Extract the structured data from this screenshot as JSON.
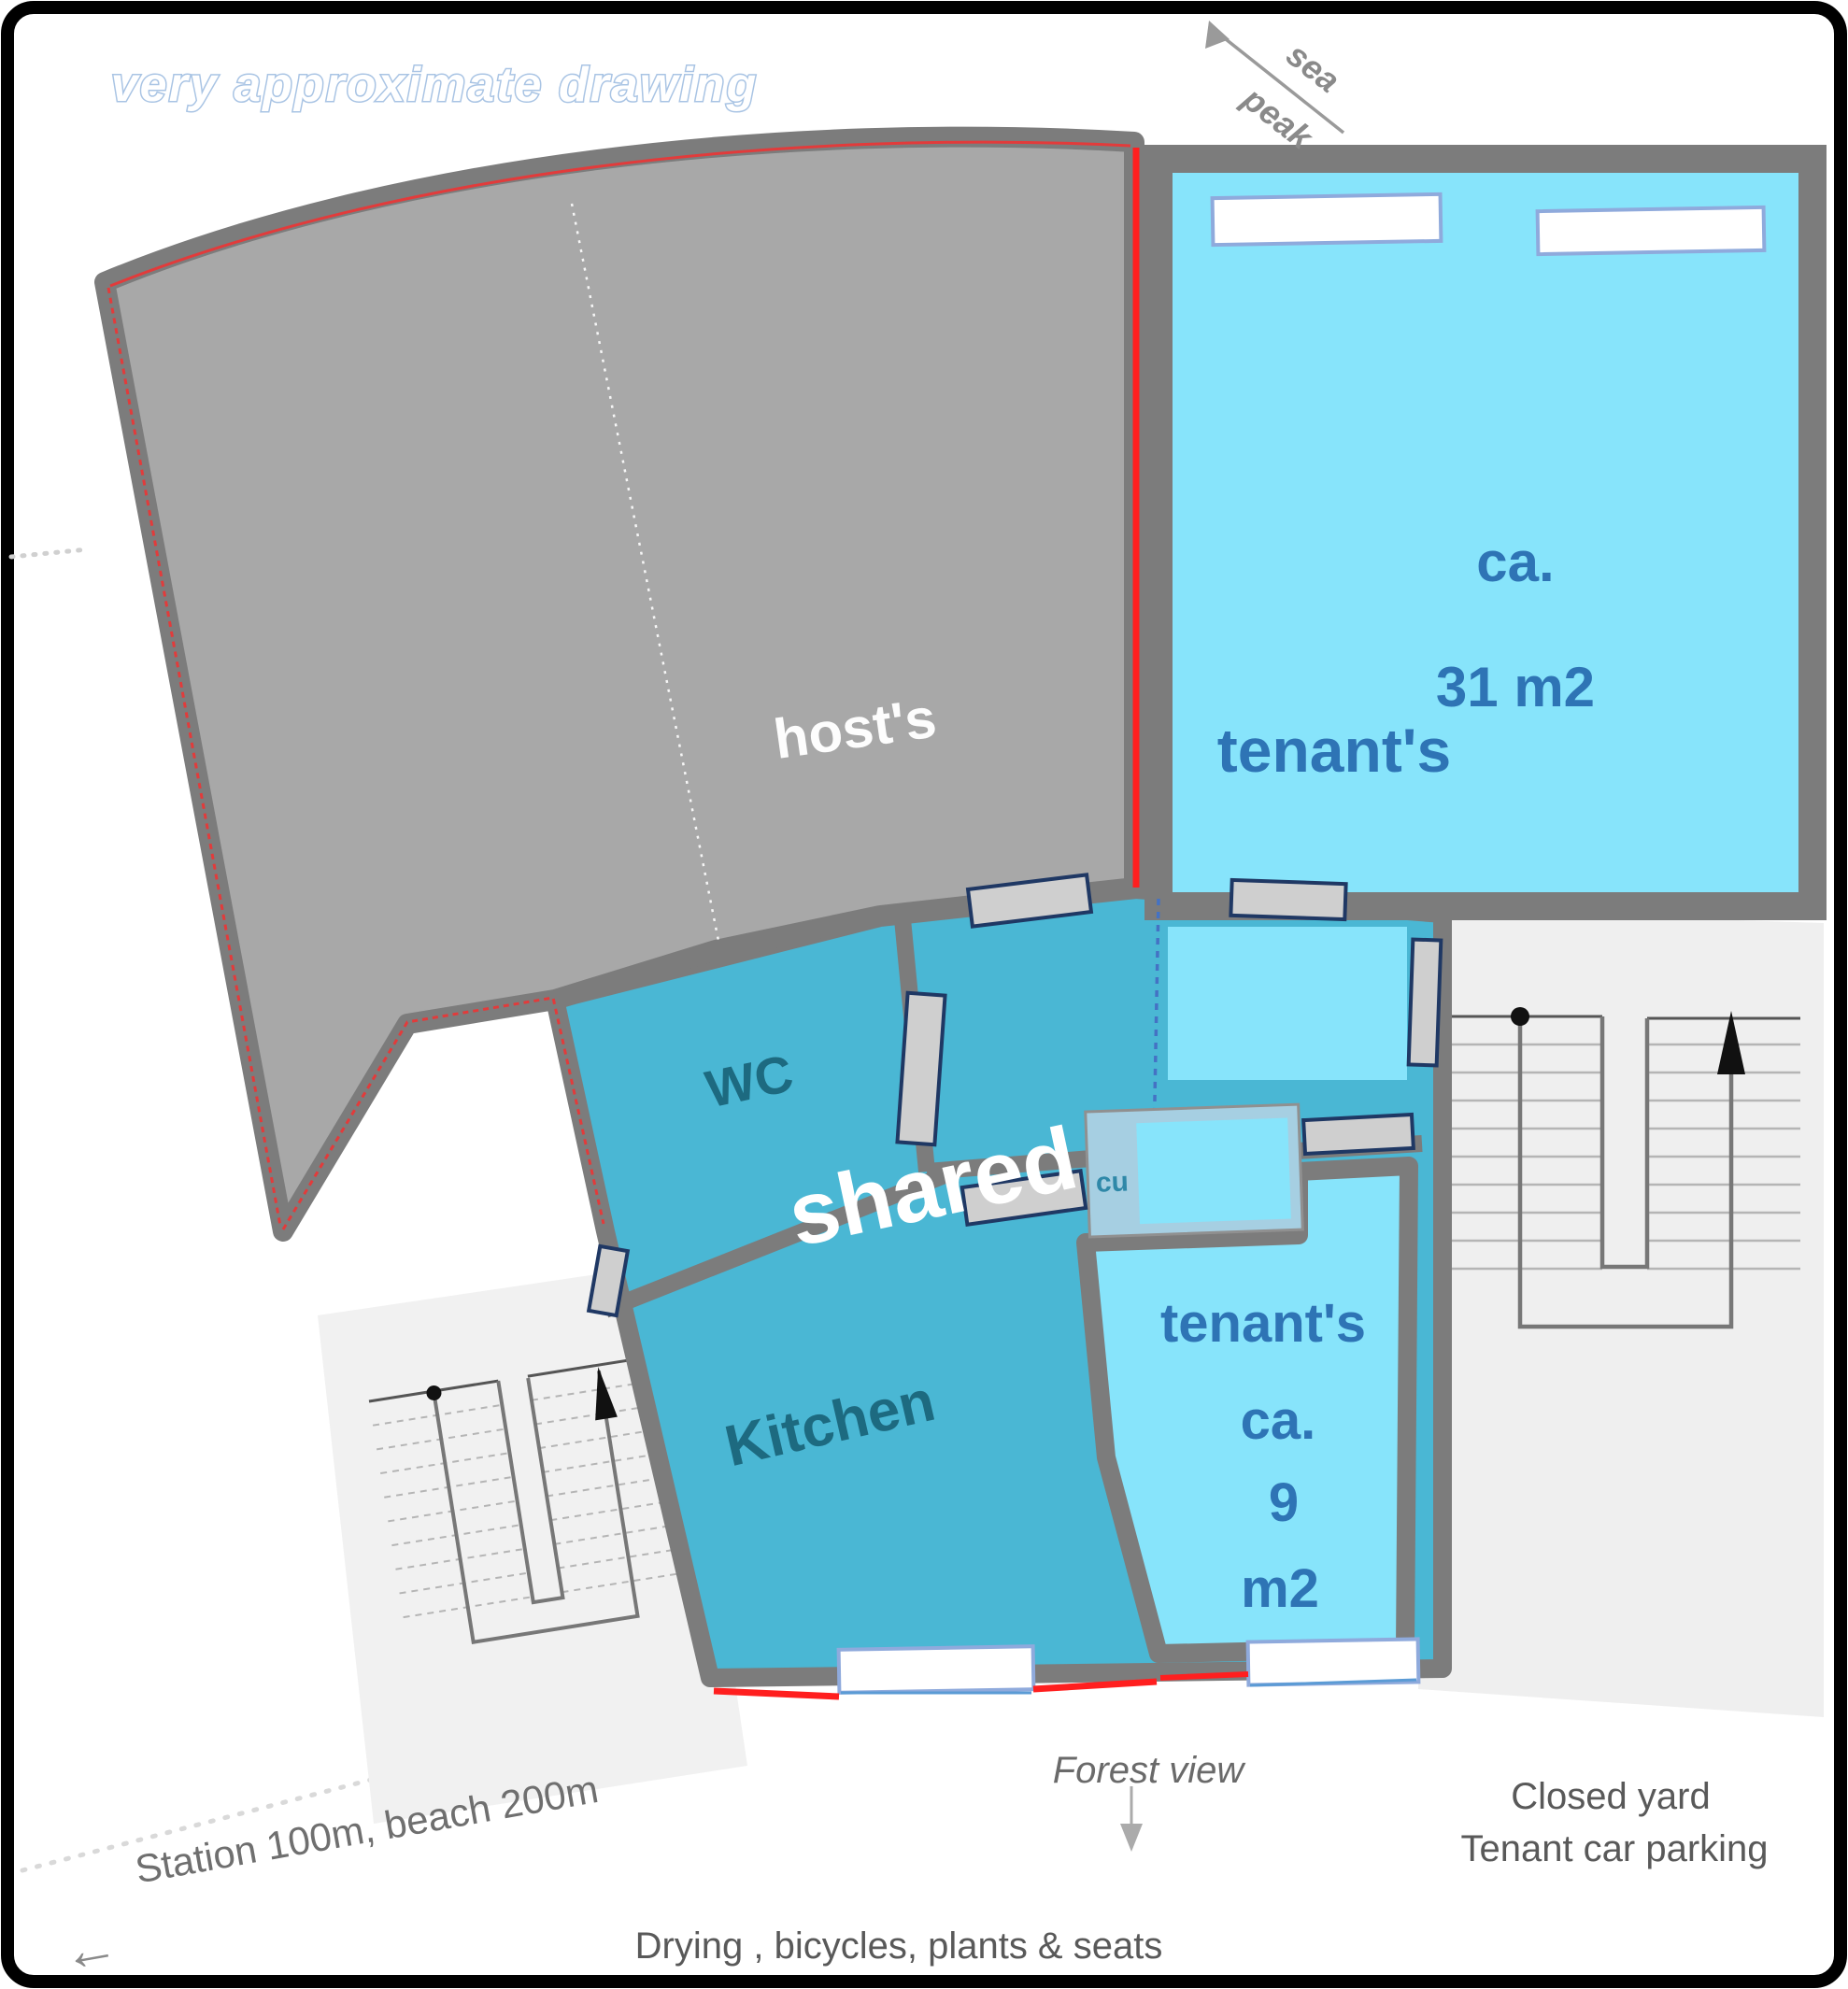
{
  "title": "very approximate drawing",
  "compass": {
    "sea": "sea",
    "peak": "peak"
  },
  "rooms": {
    "host": {
      "label": "host's"
    },
    "tenant_large": {
      "label": "tenant's",
      "area_prefix": "ca.",
      "area": "31 m2"
    },
    "wc": {
      "label": "WC"
    },
    "shared": {
      "label": "shared"
    },
    "kitchen": {
      "label": "Kitchen"
    },
    "cupboard": {
      "label": "cu"
    },
    "tenant_small": {
      "label": "tenant's",
      "area_prefix": "ca.",
      "area_value": "9",
      "area_unit": "m2"
    }
  },
  "annotations": {
    "forest_view": "Forest  view",
    "closed_yard_line1": "Closed yard",
    "closed_yard_line2": "Tenant car parking",
    "station_beach": "Station 100m,  beach 200m",
    "yard_uses": "Drying , bicycles, plants & seats"
  },
  "icons": {
    "station_arrow": "←"
  },
  "colors": {
    "host_fill": "#a8a8a8",
    "wall": "#7c7c7c",
    "shared_teal": "#4ab7d4",
    "room_blue": "#87e4fb",
    "cupboard_outer": "#a6cfe2",
    "red_accent": "#ff1f1f",
    "red_soft": "#e23b3b",
    "label_blue": "#2e74b5",
    "label_teal": "#1d6a80",
    "cu_teal": "#2f88a8",
    "window_border": "#8faadc",
    "dash_blue": "#4472c4"
  }
}
